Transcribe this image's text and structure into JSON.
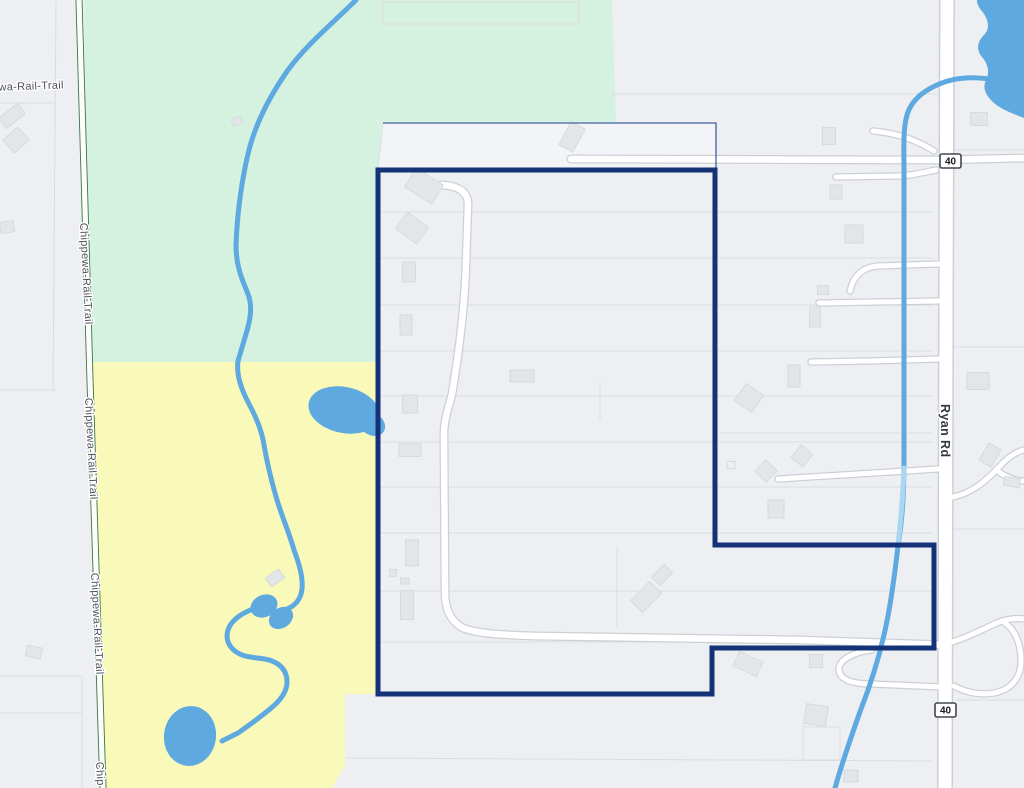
{
  "map": {
    "labels": {
      "trail_name": "Chippewa-Rail-Trail",
      "trail_name_partial": "Chip",
      "road_name": "Ryan Rd",
      "route_badge": "40"
    },
    "colors": {
      "base": "#edeff2",
      "parcel_alt": "#f2f4f7",
      "green_area": "#d5f2e1",
      "yellow_area": "#f9f9ba",
      "water": "#5ea9df",
      "water_light": "#a9d7f2",
      "boundary": "#143278",
      "boundary_thin": "#3f5fa3",
      "road_fill": "#ffffff",
      "road_casing": "#ccd0d5",
      "trail_green": "#38754c",
      "building_fill": "#e3e6e9",
      "building_stroke": "#d3d6da",
      "parcel_line": "#d9dce1",
      "label_text": "#4e525a",
      "road_label_text": "#34383e",
      "badge_border": "#42464c",
      "badge_text": "#17191c"
    }
  }
}
